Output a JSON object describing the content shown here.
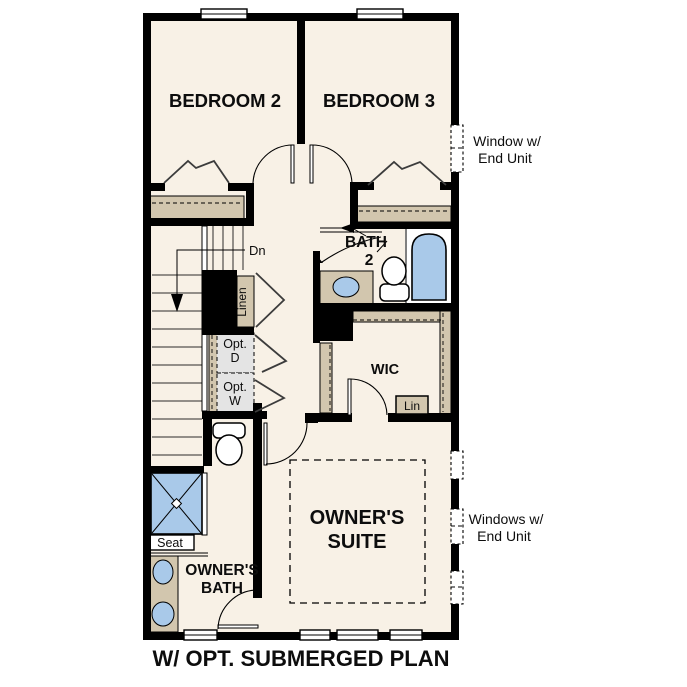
{
  "title": "W/ OPT. SUBMERGED PLAN",
  "rooms": {
    "bedroom2": "BEDROOM 2",
    "bedroom3": "BEDROOM 3",
    "bath2_line1": "BATH",
    "bath2_line2": "2",
    "wic": "WIC",
    "owners_suite_line1": "OWNER'S",
    "owners_suite_line2": "SUITE",
    "owners_bath_line1": "OWNER'S",
    "owners_bath_line2": "BATH"
  },
  "labels": {
    "stairs_down": "Dn",
    "linen": "Linen",
    "lin": "Lin",
    "opt_d_line1": "Opt.",
    "opt_d_line2": "D",
    "opt_w_line1": "Opt.",
    "opt_w_line2": "W",
    "seat": "Seat"
  },
  "annotations": {
    "window_top_line1": "Window w/",
    "window_top_line2": "End Unit",
    "windows_bottom_line1": "Windows w/",
    "windows_bottom_line2": "End Unit"
  },
  "colors": {
    "wall": "#000000",
    "floor": "#f8f1e6",
    "tan": "#d2c6ae",
    "blue": "#a9c9e9",
    "gray": "#e4e4e4"
  }
}
